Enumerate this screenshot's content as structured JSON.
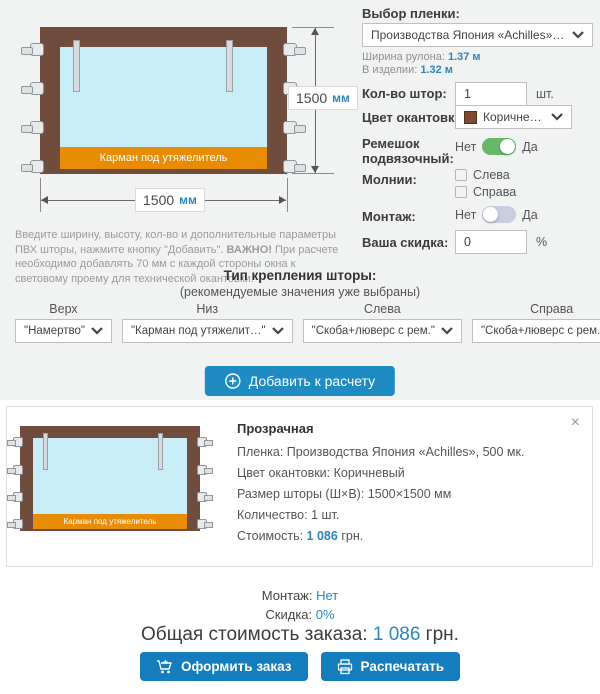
{
  "colors": {
    "panel_bg": "#f1f2f2",
    "accent_blue": "#1e8bc3",
    "action_blue": "#137dbd",
    "value_blue": "#2e86b9",
    "toggle_green": "#67b868",
    "toggle_gray": "#c9cde2",
    "frame_brown": "#6f4c3b",
    "film_blue": "#c9edf6",
    "pocket_orange": "#e78c04",
    "swatch_brown": "#7b4b34"
  },
  "diagram": {
    "height_value": "1500",
    "width_value": "1500",
    "unit": "мм",
    "pocket": "Карман под утяжелитель"
  },
  "form": {
    "film": {
      "label": "Выбор пленки:",
      "selected": "Производства Япония «Achilles», 500 мк.",
      "roll_width_label": "Ширина рулона:",
      "roll_width_value": "1.37 м",
      "product_width_label": "В изделии:",
      "product_width_value": "1.32 м"
    },
    "quantity": {
      "label": "Кол-во штор:",
      "value": "1",
      "unit": "шт."
    },
    "edging": {
      "label": "Цвет окантовки:",
      "selected": "Коричневый"
    },
    "tie_strap": {
      "label": "Ремешок подвязочный:",
      "off": "Нет",
      "on": "Да",
      "state": "on"
    },
    "zippers": {
      "label": "Молнии:",
      "options": [
        "Слева",
        "Справа"
      ]
    },
    "mounting": {
      "label": "Монтаж:",
      "off": "Нет",
      "on": "Да",
      "state": "off"
    },
    "discount": {
      "label": "Ваша скидка:",
      "value": "0",
      "unit": "%"
    }
  },
  "intro": {
    "part1": "Введите ширину, высоту, кол-во и дополнительные параметры ПВХ шторы, нажмите кнопку \"Добавить\". ",
    "bold": "ВАЖНО!",
    "part2": " При расчете необходимо добавлять 70 мм с каждой стороны окна к световому проему для технической окантовки."
  },
  "fastening": {
    "title": "Тип крепления шторы:",
    "subtitle": "(рекомендуемые значения уже выбраны)",
    "items": [
      {
        "label": "Верх",
        "value": "\"Намертво\""
      },
      {
        "label": "Низ",
        "value": "\"Карман под утяжелит…\""
      },
      {
        "label": "Слева",
        "value": "\"Скоба+люверс с рем.\""
      },
      {
        "label": "Справа",
        "value": "\"Скоба+люверс с рем.\""
      }
    ]
  },
  "add_button": {
    "label": "Добавить к расчету"
  },
  "item_card": {
    "title": "Прозрачная",
    "close": "×",
    "pocket": "Карман под утяжелитель",
    "rows": [
      {
        "label": "Пленка:",
        "value": "Производства Япония «Achilles», 500 мк."
      },
      {
        "label": "Цвет окантовки:",
        "value": "Коричневый"
      },
      {
        "label": "Размер шторы (Ш×В):",
        "value": "1500×1500 мм"
      },
      {
        "label": "Количество:",
        "value": "1 шт."
      }
    ],
    "price_label": "Стоимость:",
    "price_value": "1 086",
    "price_unit": "грн."
  },
  "summary": {
    "mounting_label": "Монтаж:",
    "mounting_value": "Нет",
    "discount_label": "Скидка:",
    "discount_value": "0%",
    "total_label": "Общая стоимость заказа:",
    "total_value": "1 086",
    "total_unit": "грн."
  },
  "actions": {
    "checkout": "Оформить заказ",
    "print": "Распечатать"
  }
}
